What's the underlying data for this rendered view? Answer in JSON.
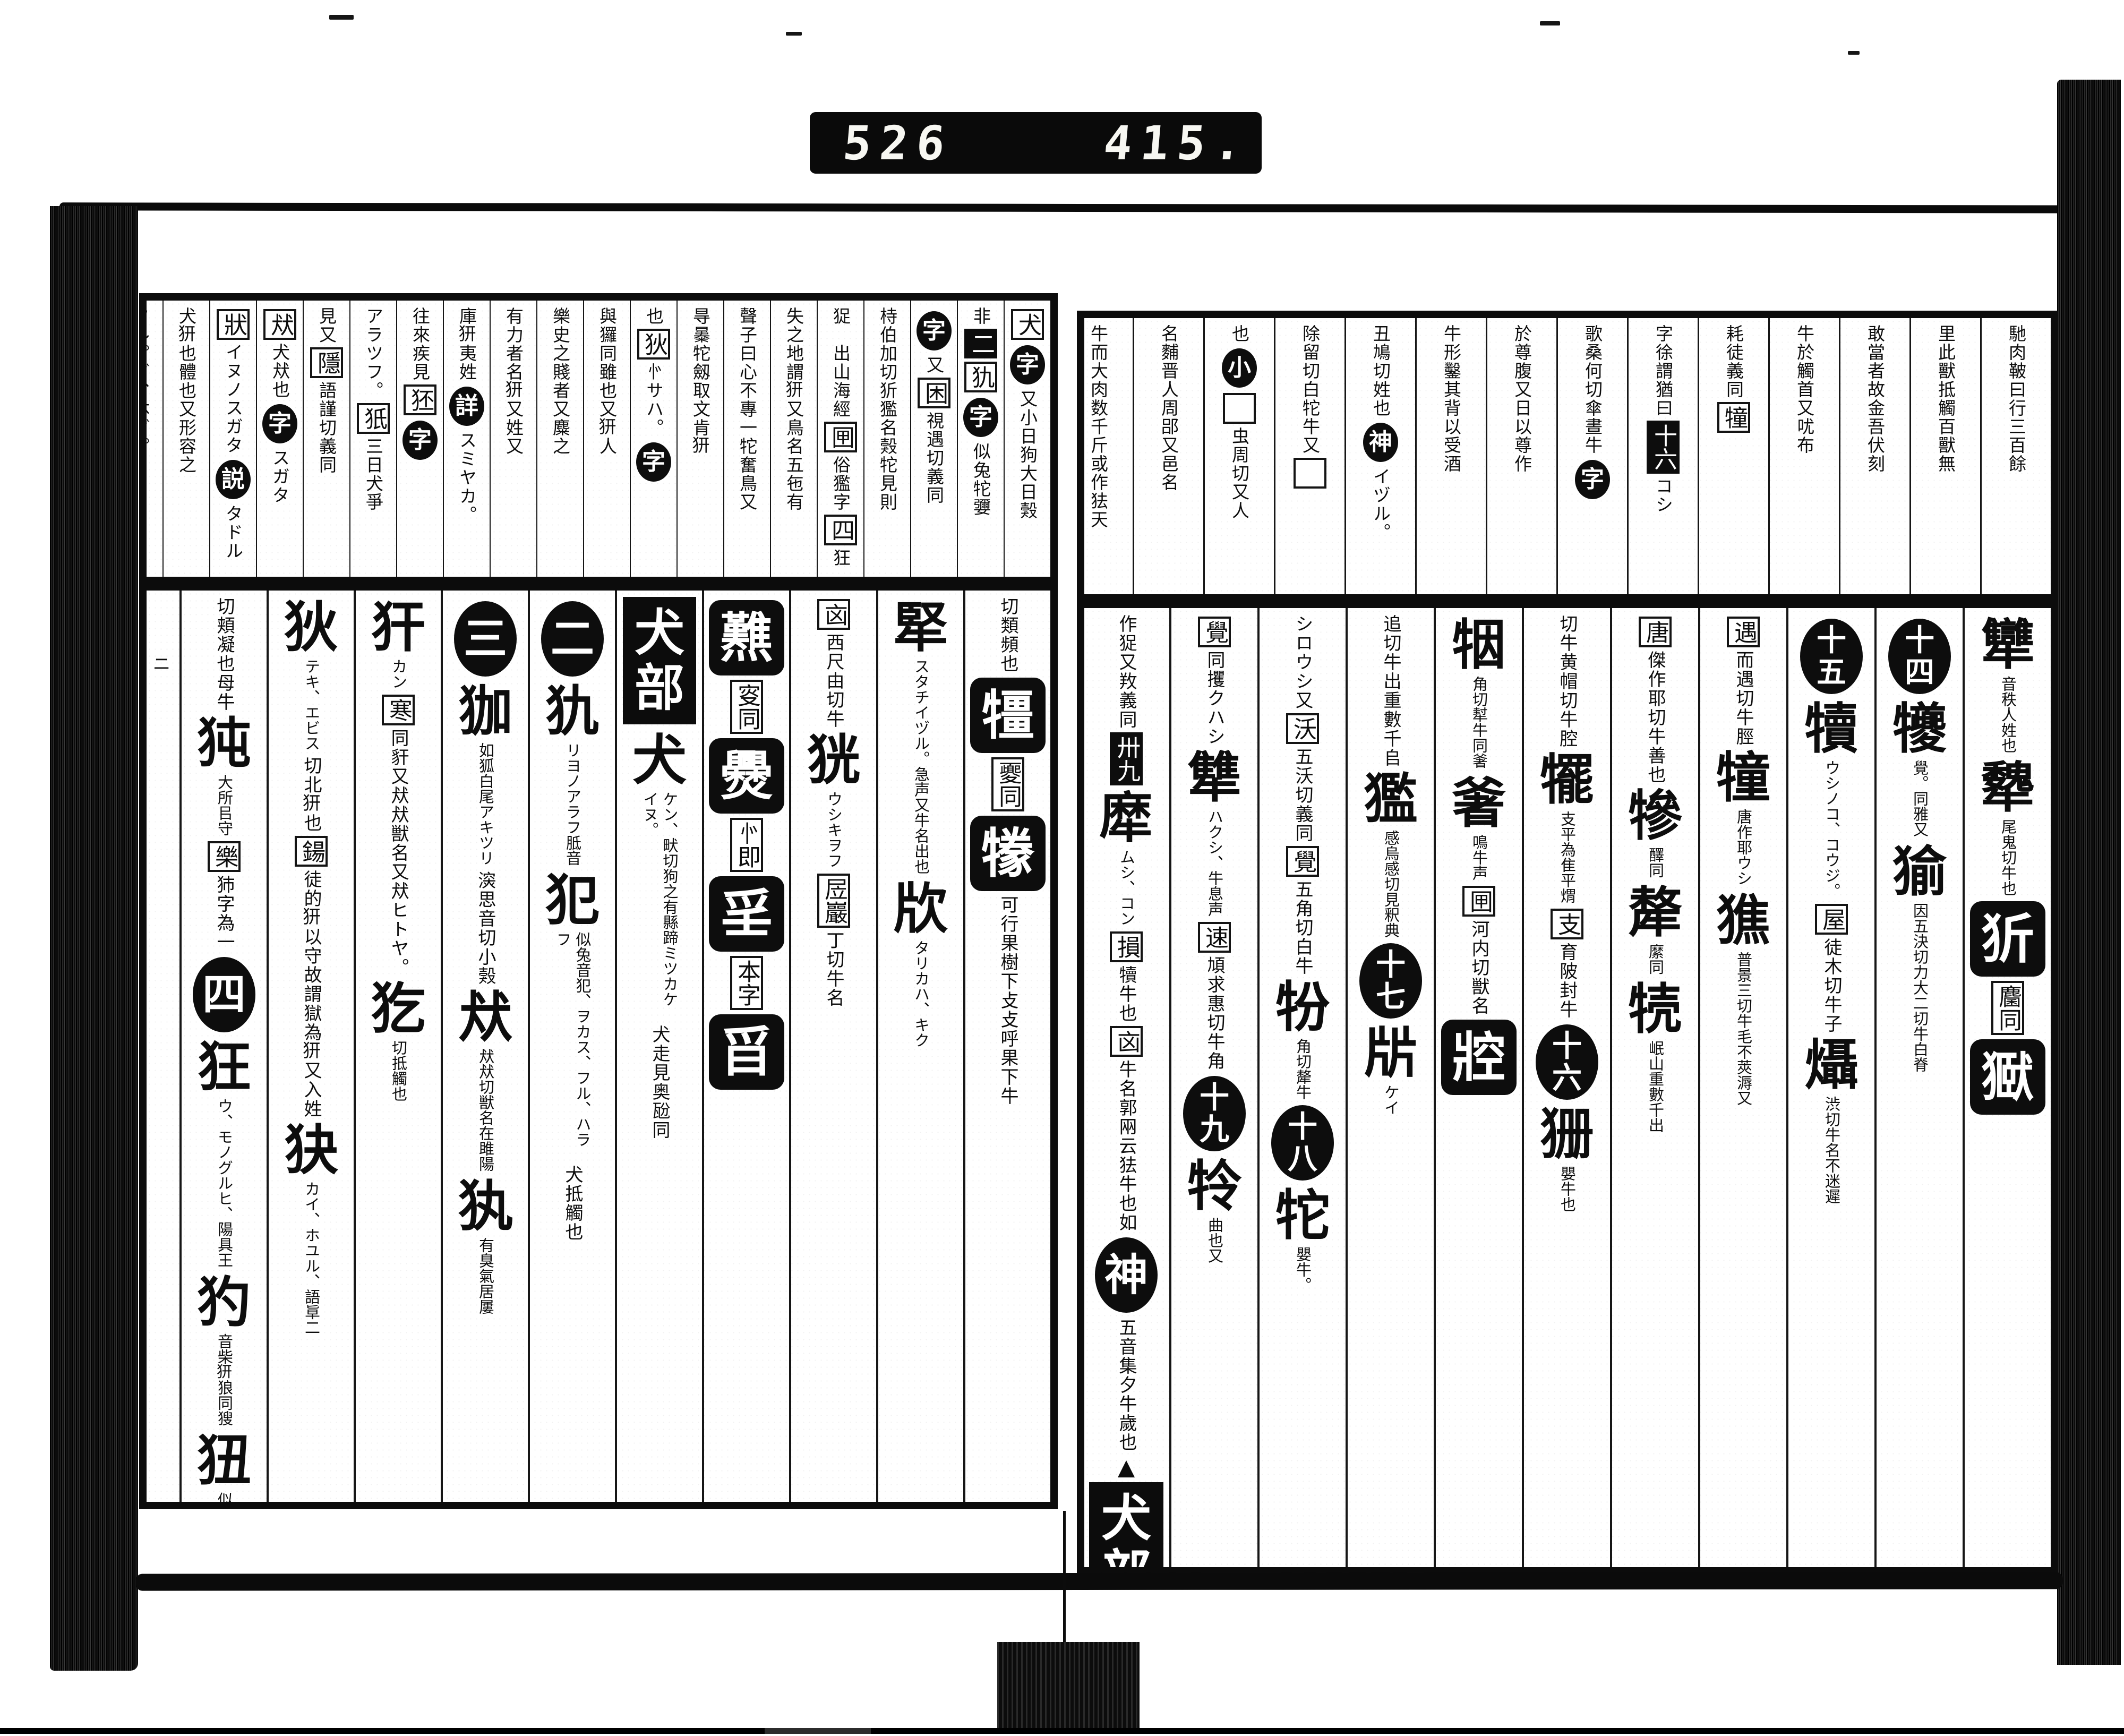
{
  "counter": {
    "left_digits": "526",
    "right_digits": "415."
  },
  "scan": {
    "ink_color": "#0d0d0d",
    "paper_color": "#ffffff"
  },
  "right_page": {
    "radical_section": "牛部",
    "top_note_columns": [
      {
        "blocks": [
          {
            "t": "txt",
            "v": "馳肉鞁曰行三百餘"
          }
        ]
      },
      {
        "blocks": [
          {
            "t": "txt",
            "v": "里此獸抵觸百獸無"
          }
        ]
      },
      {
        "blocks": [
          {
            "t": "txt",
            "v": "敢當者故金吾伏刻"
          }
        ]
      },
      {
        "blocks": [
          {
            "t": "txt",
            "v": "牛於觸首又㕱布"
          }
        ]
      },
      {
        "blocks": [
          {
            "t": "txt",
            "v": "耗徒義同"
          },
          {
            "t": "box",
            "v": "犝"
          }
        ]
      },
      {
        "blocks": [
          {
            "t": "txt",
            "v": "字徐謂猶曰"
          },
          {
            "t": "invs",
            "v": "十六"
          },
          {
            "t": "txt",
            "v": "コシ"
          }
        ]
      },
      {
        "blocks": [
          {
            "t": "txt",
            "v": "歌桑何切傘晝牛"
          },
          {
            "t": "circ",
            "v": "字"
          }
        ]
      },
      {
        "blocks": [
          {
            "t": "txt",
            "v": "於尊腹又日以尊作"
          }
        ]
      },
      {
        "blocks": [
          {
            "t": "txt",
            "v": "牛形鑿其背以受酒"
          }
        ]
      },
      {
        "blocks": [
          {
            "t": "txt",
            "v": "丑鳩切姓也"
          },
          {
            "t": "circ",
            "v": "神"
          },
          {
            "t": "txt",
            "v": "イヅル。"
          }
        ]
      },
      {
        "blocks": [
          {
            "t": "txt",
            "v": "除留切白㸰牛又"
          },
          {
            "t": "box",
            "v": "𠀘"
          }
        ]
      },
      {
        "blocks": [
          {
            "t": "txt",
            "v": "也"
          },
          {
            "t": "circ",
            "v": "小"
          },
          {
            "t": "box",
            "v": "𠀘"
          },
          {
            "t": "txt",
            "v": "虫周切又人"
          }
        ]
      },
      {
        "blocks": [
          {
            "t": "txt",
            "v": "名麱晋人周郘又邑名"
          }
        ]
      },
      {
        "blocks": [
          {
            "t": "txt",
            "v": "牛而大肉数千斤或作㹤天"
          }
        ]
      }
    ],
    "main_columns": [
      {
        "blocks": [
          {
            "t": "head",
            "v": "犫",
            "g": "音秩人姓也"
          },
          {
            "t": "head",
            "v": "犩",
            "g": "尾鬼切牛也"
          },
          {
            "t": "inv",
            "v": "㹞"
          },
          {
            "t": "box",
            "v": "麕同"
          },
          {
            "t": "inv",
            "v": "㺇"
          }
        ]
      },
      {
        "blocks": [
          {
            "t": "circ",
            "v": "十四"
          },
          {
            "t": "head",
            "v": "犪",
            "g": "覺。同雅又"
          },
          {
            "t": "head",
            "v": "㺄",
            "g": "因五決切力大二切牛白脊"
          }
        ]
      },
      {
        "blocks": [
          {
            "t": "circ",
            "v": "十五"
          },
          {
            "t": "head",
            "v": "犢",
            "g": "ウシノコ、コウジ。"
          },
          {
            "t": "box",
            "v": "屋"
          },
          {
            "t": "txt",
            "v": "徒木切牛子"
          },
          {
            "t": "head",
            "v": "㸎",
            "g": "渋切牛名不迷遲"
          }
        ]
      },
      {
        "blocks": [
          {
            "t": "box",
            "v": "遇"
          },
          {
            "t": "txt",
            "v": "而遇切牛脛"
          },
          {
            "t": "head",
            "v": "犝",
            "g": "唐作耶ウシ"
          },
          {
            "t": "head",
            "v": "㺘",
            "g": "普景三切牛毛不莢溽又"
          }
        ]
      },
      {
        "blocks": [
          {
            "t": "box",
            "v": "唐"
          },
          {
            "t": "txt",
            "v": "傑作耶切牛善也"
          },
          {
            "t": "head",
            "v": "犙",
            "g": "醳同"
          },
          {
            "t": "head",
            "v": "犛",
            "g": "縻同"
          },
          {
            "t": "head",
            "v": "㸿",
            "g": "岷山重數千出"
          }
        ]
      },
      {
        "blocks": [
          {
            "t": "txt",
            "v": "切牛黄帽切牛腔"
          },
          {
            "t": "head",
            "v": "犤",
            "g": "支平為隹平煟"
          },
          {
            "t": "box",
            "v": "支"
          },
          {
            "t": "txt",
            "v": "育陂封牛"
          },
          {
            "t": "circ",
            "v": "十六"
          },
          {
            "t": "head",
            "v": "㹪",
            "g": "嬰牛也"
          }
        ]
      },
      {
        "blocks": [
          {
            "t": "head",
            "v": "㸶",
            "g": "角切犎牛同㸙"
          },
          {
            "t": "head",
            "v": "㸙",
            "g": "鳴牛声"
          },
          {
            "t": "box",
            "v": "㘡"
          },
          {
            "t": "txt",
            "v": "河内切獣名"
          },
          {
            "t": "inv",
            "v": "㸜"
          }
        ]
      },
      {
        "blocks": [
          {
            "t": "txt",
            "v": "追切牛出重數千𠂤"
          },
          {
            "t": "head",
            "v": "㺝",
            "g": "感烏感切見釈典"
          },
          {
            "t": "circ",
            "v": "十七"
          },
          {
            "t": "head",
            "v": "㸞",
            "g": "ケイ"
          }
        ]
      },
      {
        "blocks": [
          {
            "t": "txt",
            "v": "シロウシ又"
          },
          {
            "t": "box",
            "v": "沃"
          },
          {
            "t": "txt",
            "v": "五沃切義同"
          },
          {
            "t": "box",
            "v": "覺"
          },
          {
            "t": "txt",
            "v": "五角切白牛"
          },
          {
            "t": "head",
            "v": "㸮",
            "g": "角切犛牛"
          },
          {
            "t": "circ",
            "v": "十八"
          },
          {
            "t": "head",
            "v": "㸰",
            "g": "嬰牛。"
          }
        ]
      },
      {
        "blocks": [
          {
            "t": "box",
            "v": "覺"
          },
          {
            "t": "txt",
            "v": "同攫クハシ"
          },
          {
            "t": "head",
            "v": "犨",
            "g": "ハクシ、牛息声"
          },
          {
            "t": "box",
            "v": "速"
          },
          {
            "t": "txt",
            "v": "頄求惠切牛角"
          },
          {
            "t": "circ",
            "v": "十九"
          },
          {
            "t": "head",
            "v": "㸳",
            "g": "曲也又"
          }
        ]
      },
      {
        "blocks": [
          {
            "t": "txt",
            "v": "作㹱又䍩義同"
          },
          {
            "t": "invs",
            "v": "卅九"
          },
          {
            "t": "head",
            "v": "犘",
            "g": "ムシ、コン"
          },
          {
            "t": "box",
            "v": "損"
          },
          {
            "t": "txt",
            "v": "犢牛也"
          },
          {
            "t": "box",
            "v": "㐫"
          },
          {
            "t": "txt",
            "v": "牛名郭㒳云㹤牛也如"
          },
          {
            "t": "circ",
            "v": "神"
          },
          {
            "t": "txt",
            "v": "五音集夕牛歲也"
          },
          {
            "t": "tri",
            "v": "▲"
          },
          {
            "t": "hdr",
            "v": "犬部"
          }
        ]
      }
    ]
  },
  "left_page": {
    "radical_section": "犬部",
    "top_note_columns": [
      {
        "blocks": [
          {
            "t": "box",
            "v": "犬"
          },
          {
            "t": "circ",
            "v": "字"
          },
          {
            "t": "txt",
            "v": "又小日狗大日㺉"
          }
        ]
      },
      {
        "blocks": [
          {
            "t": "txt",
            "v": "非"
          },
          {
            "t": "invs",
            "v": "二"
          },
          {
            "t": "box",
            "v": "犰"
          },
          {
            "t": "circ",
            "v": "字"
          },
          {
            "t": "txt",
            "v": "似兔㸰㜷"
          }
        ]
      },
      {
        "blocks": [
          {
            "t": "circ",
            "v": "字"
          },
          {
            "t": "txt",
            "v": "又"
          },
          {
            "t": "box",
            "v": "困"
          },
          {
            "t": "txt",
            "v": "視遇切義同"
          }
        ]
      },
      {
        "blocks": [
          {
            "t": "txt",
            "v": "㭙伯加切㹞㺝名㺉㸰見則"
          }
        ]
      },
      {
        "blocks": [
          {
            "t": "txt",
            "v": "㹱𠀘出山海經"
          },
          {
            "t": "box",
            "v": "㘡"
          },
          {
            "t": "txt",
            "v": "俗㺝字"
          },
          {
            "t": "box",
            "v": "四"
          },
          {
            "t": "txt",
            "v": "狂"
          }
        ]
      },
      {
        "blocks": [
          {
            "t": "txt",
            "v": "失之地謂𤜵又鳥名五㐌有𩾭"
          }
        ]
      },
      {
        "blocks": [
          {
            "t": "txt",
            "v": "聲子曰心不專一㸰奮鳥又"
          }
        ]
      },
      {
        "blocks": [
          {
            "t": "txt",
            "v": "㝵㬥㸰劔取文肯𤜵"
          }
        ]
      },
      {
        "blocks": [
          {
            "t": "txt",
            "v": "也"
          },
          {
            "t": "box",
            "v": "狄"
          },
          {
            "t": "txt",
            "v": "㣺サハ。"
          },
          {
            "t": "circ",
            "v": "字"
          }
        ]
      },
      {
        "blocks": [
          {
            "t": "txt",
            "v": "與玀同雖也又𤜵人"
          }
        ]
      },
      {
        "blocks": [
          {
            "t": "txt",
            "v": "樂史之賤者又麋之"
          }
        ]
      },
      {
        "blocks": [
          {
            "t": "txt",
            "v": "有力者名𤜵又姓又"
          }
        ]
      },
      {
        "blocks": [
          {
            "t": "txt",
            "v": "庫𤜵夷姓"
          },
          {
            "t": "circ",
            "v": "詳"
          },
          {
            "t": "txt",
            "v": "スミヤカ。"
          }
        ]
      },
      {
        "blocks": [
          {
            "t": "txt",
            "v": "往來疾見"
          },
          {
            "t": "box",
            "v": "狉"
          },
          {
            "t": "circ",
            "v": "字"
          }
        ]
      },
      {
        "blocks": [
          {
            "t": "txt",
            "v": "アラツフ。"
          },
          {
            "t": "box",
            "v": "㹝"
          },
          {
            "t": "txt",
            "v": "三日犬爭"
          }
        ]
      },
      {
        "blocks": [
          {
            "t": "txt",
            "v": "見又"
          },
          {
            "t": "box",
            "v": "隱"
          },
          {
            "t": "txt",
            "v": "語謹切義同"
          }
        ]
      },
      {
        "blocks": [
          {
            "t": "box",
            "v": "㹜"
          },
          {
            "t": "txt",
            "v": "犬㹜也"
          },
          {
            "t": "circ",
            "v": "字"
          },
          {
            "t": "txt",
            "v": "スガタ"
          }
        ]
      },
      {
        "blocks": [
          {
            "t": "box",
            "v": "狀"
          },
          {
            "t": "txt",
            "v": "イヌノスガタ"
          },
          {
            "t": "circ",
            "v": "説"
          },
          {
            "t": "txt",
            "v": "タドル"
          }
        ]
      },
      {
        "blocks": [
          {
            "t": "txt",
            "v": "犬𤜵也體也又形容之"
          }
        ]
      },
      {
        "blocks": [
          {
            "t": "txt",
            "v": "フル。グ、体ダ。"
          }
        ]
      }
    ],
    "main_columns": [
      {
        "blocks": [
          {
            "t": "txt",
            "v": "切類頻也"
          },
          {
            "t": "inv",
            "v": "㹔"
          },
          {
            "t": "box",
            "v": "夒同"
          },
          {
            "t": "inv",
            "v": "㹖"
          },
          {
            "t": "txt",
            "v": "可行果樹下攴攴呼果下牛"
          }
        ]
      },
      {
        "blocks": [
          {
            "t": "head",
            "v": "㹂",
            "g": "スタチイヅル。急声又牛名出也"
          },
          {
            "t": "head",
            "v": "㸝",
            "g": "タリカハ、キク"
          }
        ]
      },
      {
        "blocks": [
          {
            "t": "box",
            "v": "㐫"
          },
          {
            "t": "txt",
            "v": "西尺由切牛"
          },
          {
            "t": "head",
            "v": "㹰",
            "g": "ウシキヲフ"
          },
          {
            "t": "box",
            "v": "㞐巖"
          },
          {
            "t": "txt",
            "v": "丁切牛名"
          }
        ]
      },
      {
        "blocks": [
          {
            "t": "inv",
            "v": "㸐"
          },
          {
            "t": "box",
            "v": "叜同"
          },
          {
            "t": "inv",
            "v": "㸑"
          },
          {
            "t": "box",
            "v": "㣺即"
          },
          {
            "t": "inv",
            "v": "㸒"
          },
          {
            "t": "box",
            "v": "本字"
          },
          {
            "t": "inv",
            "v": "㸓"
          }
        ]
      },
      {
        "blocks": [
          {
            "t": "hdr",
            "v": "犬部"
          },
          {
            "t": "head",
            "v": "犬",
            "g": "ケン、畎切狗之有縣蹄ミツカケイヌ。"
          },
          {
            "t": "txt",
            "v": "犬走見奥瓰同"
          }
        ]
      },
      {
        "blocks": [
          {
            "t": "circ",
            "v": "二"
          },
          {
            "t": "head",
            "v": "犰",
            "g": "リヨノアラフ胝音"
          },
          {
            "t": "head",
            "v": "犯",
            "g": "似兔音犯、ヲカス、フル、ハラフ"
          },
          {
            "t": "txt",
            "v": "犬抵觸也"
          }
        ]
      },
      {
        "blocks": [
          {
            "t": "circ",
            "v": "三"
          },
          {
            "t": "head",
            "v": "㹢",
            "g": "如狐白尾アキツリ"
          },
          {
            "t": "txt",
            "v": "㴱思音切小㺉"
          },
          {
            "t": "head",
            "v": "㹜",
            "g": "㹜㹜切獣名在雎陽"
          },
          {
            "t": "head",
            "v": "犱",
            "g": "有臭氣居屢"
          }
        ]
      },
      {
        "blocks": [
          {
            "t": "head",
            "v": "犴",
            "g": "カン"
          },
          {
            "t": "box",
            "v": "寒"
          },
          {
            "t": "txt",
            "v": "同豻又㹜㹜獣名又㹜ヒトヤ。"
          },
          {
            "t": "head",
            "v": "犵",
            "g": "切抵觸也"
          }
        ]
      },
      {
        "blocks": [
          {
            "t": "head",
            "v": "狄",
            "g": "テキ、エビス"
          },
          {
            "t": "txt",
            "v": "切北𤜵也"
          },
          {
            "t": "box",
            "v": "鍚"
          },
          {
            "t": "txt",
            "v": "徒的𤜵以守故謂獄為𤜵又入姓"
          },
          {
            "t": "head",
            "v": "㹟",
            "g": "カイ、ホユル、語㔬二"
          }
        ]
      },
      {
        "blocks": [
          {
            "t": "txt",
            "v": "切頬凝也母牛"
          },
          {
            "t": "head",
            "v": "㹠",
            "g": "大所㠯守"
          },
          {
            "t": "box",
            "v": "樂"
          },
          {
            "t": "txt",
            "v": "犻字為一"
          },
          {
            "t": "circ",
            "v": "四"
          },
          {
            "t": "head",
            "v": "狂",
            "g": "ウ、モノグルヒ、陽具王"
          },
          {
            "t": "head",
            "v": "犳",
            "g": "音柴𤜵狼同獀"
          },
          {
            "t": "head",
            "v": "狃",
            "g": "似㺉而小驢父"
          }
        ]
      },
      {
        "w": 70,
        "blocks": [
          {
            "t": "txt",
            "v": "𤞑㸰斤ニ"
          }
        ]
      }
    ]
  }
}
